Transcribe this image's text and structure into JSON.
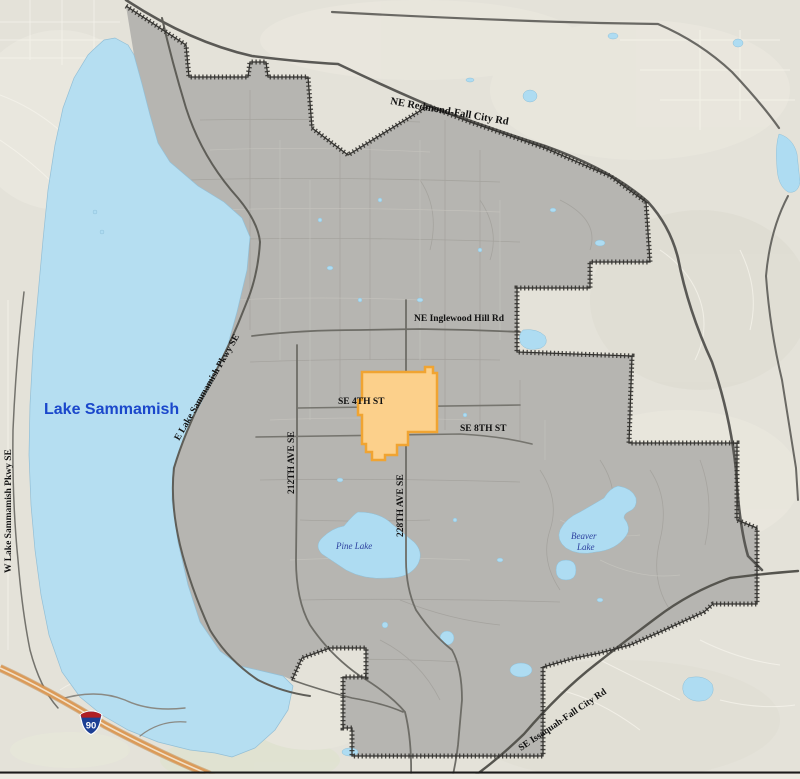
{
  "map": {
    "region_title": "Sammamish area map",
    "labels": {
      "lake_sammamish": "Lake Sammamish",
      "pine_lake": "Pine Lake",
      "beaver_lake_line1": "Beaver",
      "beaver_lake_line2": "Lake",
      "ne_redmond_fall_city_rd": "NE Redmond-Fall City Rd",
      "ne_inglewood_hill_rd": "NE Inglewood Hill Rd",
      "se_4th_st": "SE 4TH ST",
      "se_8th_st": "SE 8TH ST",
      "ave_212th": "212TH AVE SE",
      "ave_228th": "228TH AVE SE",
      "e_lake_sammamish_pkwy": "E Lake Sammamish Pkwy SE",
      "w_lake_sammamish_pkwy": "W Lake Sammamish Pkwy SE",
      "se_issaquah_fall_city_rd": "SE Issaquah-Fall City Rd",
      "interstate_90": "90"
    },
    "colors": {
      "water": "#b5def1",
      "land": "#e4e2d9",
      "city_fill": "#b6b5b1",
      "city_boundary": "#343330",
      "highlight_fill": "#fcd08b",
      "highlight_stroke": "#f0a432",
      "major_road": "#5a5955",
      "interstate_road": "#db9a58",
      "water_label": "#1a47cb",
      "small_lake_label": "#2b3f9e",
      "road_label": "#111111",
      "shield_red": "#b01f24",
      "shield_blue": "#1c3f94"
    }
  }
}
